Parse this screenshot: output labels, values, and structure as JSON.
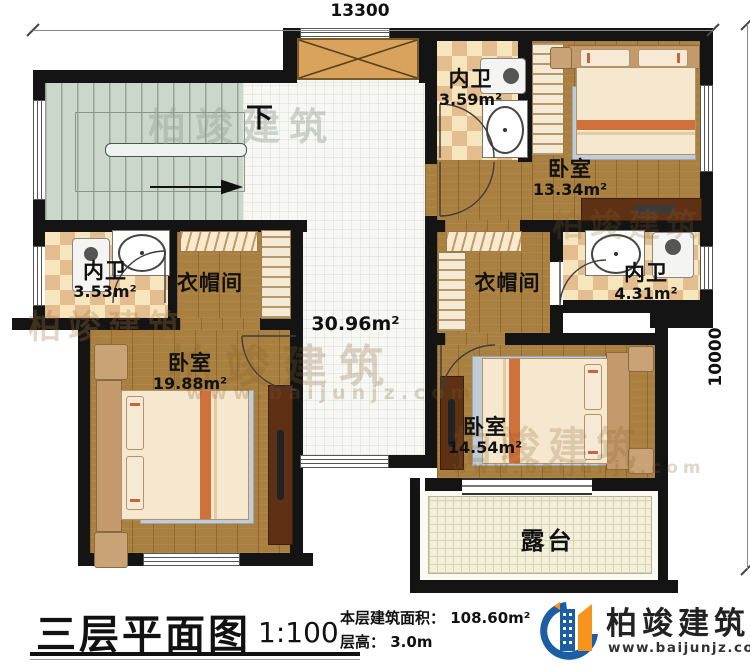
{
  "dimensions": {
    "top": "13300",
    "right": "10000"
  },
  "stairs": {
    "down_label": "下"
  },
  "rooms": {
    "bath_top": {
      "name": "内卫",
      "area": "3.59m²"
    },
    "bedroom_ne": {
      "name": "卧室",
      "area": "13.34m²"
    },
    "bath_west": {
      "name": "内卫",
      "area": "3.53m²"
    },
    "closet_west": {
      "name": "衣帽间"
    },
    "hall": {
      "area": "30.96m²"
    },
    "closet_east": {
      "name": "衣帽间"
    },
    "bath_east": {
      "name": "内卫",
      "area": "4.31m²"
    },
    "bedroom_sw": {
      "name": "卧室",
      "area": "19.88m²"
    },
    "bedroom_se": {
      "name": "卧室",
      "area": "14.54m²"
    },
    "terrace": {
      "name": "露台"
    }
  },
  "footer": {
    "title": "三层平面图",
    "scale": "1:100",
    "area_label": "本层建筑面积：",
    "area_value": "108.60m²",
    "height_label": "层高：",
    "height_value": "3.0m"
  },
  "brand": {
    "name": "柏竣建筑",
    "website": "www.baijunjz.com"
  },
  "colors": {
    "wall": "#141414",
    "wood": "#a9803f",
    "logo_blue": "#1b5ea6",
    "logo_orange": "#f7941d"
  }
}
